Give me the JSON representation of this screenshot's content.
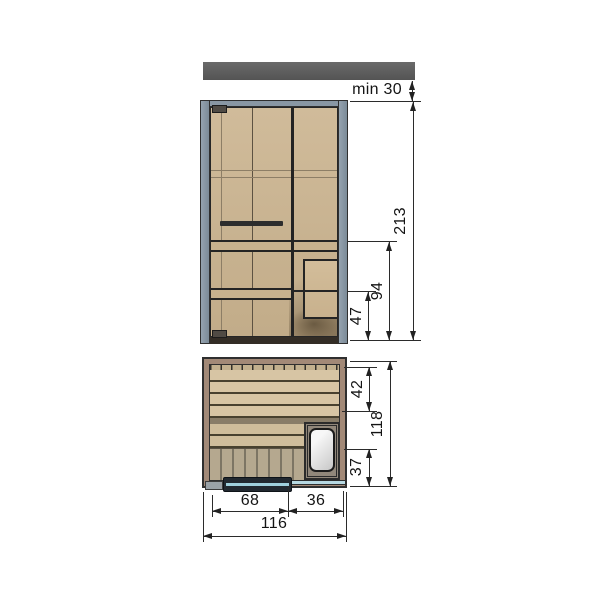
{
  "dimensions": {
    "ceiling_clearance": "min 30",
    "overall_height": "213",
    "upper_bench_height": "94",
    "lower_bench_height": "47",
    "bench_depth": "42",
    "overall_depth": "118",
    "heater_depth": "37",
    "door_width": "68",
    "heater_bay_width": "36",
    "overall_width": "116"
  },
  "colors": {
    "ceiling_bar": "#5f5f5f",
    "frame": "#8997a4",
    "wood_panel": "#cbb494",
    "plan_wall": "#a28977",
    "bench_slat": "#d7c5a4",
    "floor_slat": "#b5a88f",
    "heater_front": "#cfb996",
    "heater_top": "#f0f0f0",
    "door_glass": "#b7d9e2",
    "dimension_line": "#2b2b2b"
  }
}
